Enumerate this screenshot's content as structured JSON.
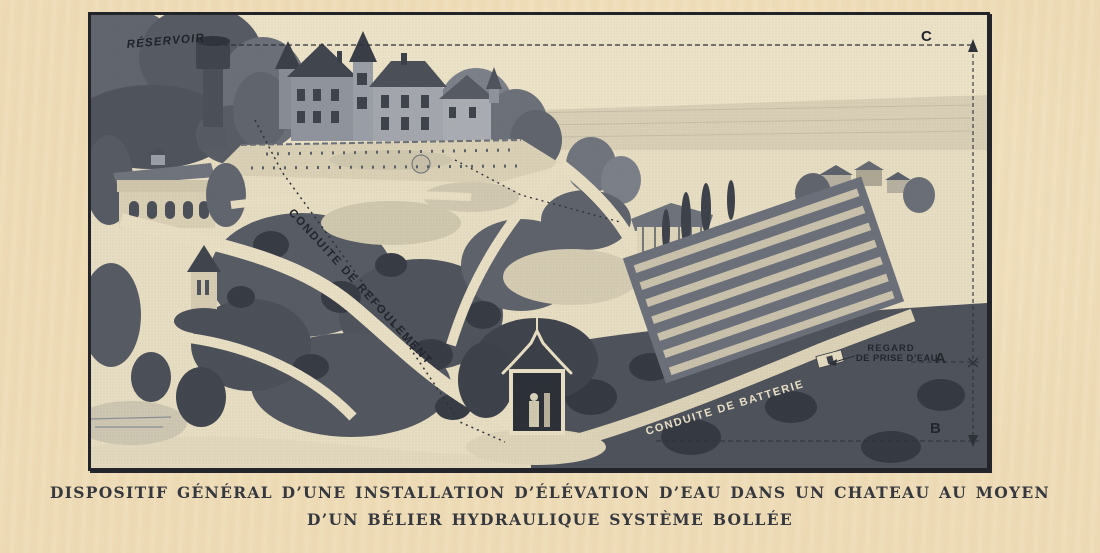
{
  "figure": {
    "labels": {
      "reservoir": "RÉSERVOIR",
      "conduite_refoulement": "CONDUITE DE REFOULEMENT",
      "conduite_batterie": "CONDUITE DE BATTERIE",
      "regard_line1": "REGARD",
      "regard_line2": "DE PRISE D’EAU",
      "point_a": "A",
      "point_b": "B",
      "point_c": "C"
    },
    "colors": {
      "paper": "#eedcb8",
      "scene_cream": "#e7ddc2",
      "ink_dark": "#2e3138",
      "engraving_dark": "#4e535c",
      "engraving_mid": "#8a8e96",
      "frame": "#22242a"
    }
  },
  "caption": {
    "line1": "DISPOSITIF GÉNÉRAL D’UNE INSTALLATION D’ÉLÉVATION D’EAU DANS UN CHATEAU AU MOYEN",
    "line2": "D’UN BÉLIER HYDRAULIQUE SYSTÈME BOLLÉE"
  }
}
